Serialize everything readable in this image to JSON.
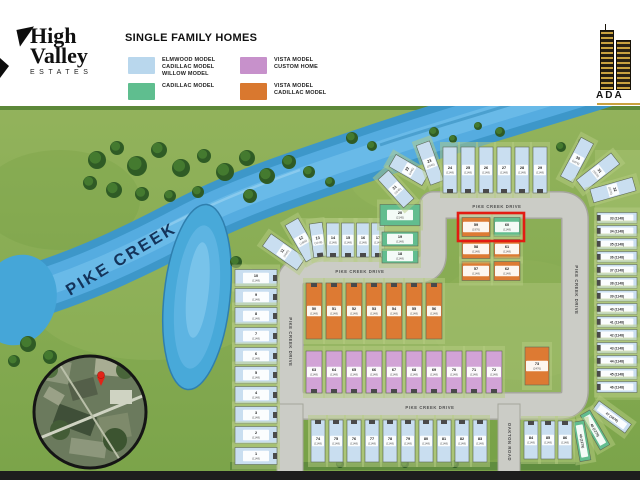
{
  "brand": {
    "line1": "High",
    "line2": "Valley",
    "line3": "ESTATES"
  },
  "legend": {
    "title": "SINGLE FAMILY HOMES",
    "items": [
      {
        "color": "#b9d7ed",
        "lines": [
          "ELMWOOD MODEL",
          "CADILLAC MODEL",
          "WILLOW MODEL"
        ]
      },
      {
        "color": "#5fbe8f",
        "lines": [
          "CADILLAC MODEL"
        ]
      },
      {
        "color": "#c791cb",
        "lines": [
          "VISTA MODEL",
          "CUSTOM HOME"
        ]
      },
      {
        "color": "#d9782f",
        "lines": [
          "VISTA MODEL",
          "CADILLAC MODEL"
        ]
      }
    ]
  },
  "builder": {
    "name": "ADA"
  },
  "site": {
    "creek_label": "PIKE CREEK",
    "colors": {
      "blue": "#c9def0",
      "green": "#62bd8f",
      "pink": "#d2a3d6",
      "orange": "#dd7a33"
    },
    "highlight": {
      "x": 458,
      "y": 213,
      "w": 66,
      "h": 28,
      "color": "#e31b12"
    },
    "roads": [
      {
        "label": "PIKE CREEK DRIVE",
        "x": 497,
        "y": 207,
        "r": 0
      },
      {
        "label": "PIKE CREEK DRIVE",
        "x": 360,
        "y": 272,
        "r": 0
      },
      {
        "label": "PIKE CREEK DRIVE",
        "x": 290,
        "y": 342,
        "r": 90
      },
      {
        "label": "PIKE CREEK DRIVE",
        "x": 576,
        "y": 290,
        "r": 90
      },
      {
        "label": "PIKE CREEK DRIVE",
        "x": 430,
        "y": 408,
        "r": 0
      },
      {
        "label": "OAKTON ROAD",
        "x": 509,
        "y": 442,
        "r": 90
      }
    ],
    "trees": [
      [
        97,
        160,
        9
      ],
      [
        117,
        148,
        7
      ],
      [
        137,
        166,
        10
      ],
      [
        159,
        150,
        8
      ],
      [
        181,
        168,
        9
      ],
      [
        204,
        156,
        7
      ],
      [
        225,
        172,
        9
      ],
      [
        247,
        158,
        8
      ],
      [
        267,
        176,
        8
      ],
      [
        289,
        162,
        7
      ],
      [
        90,
        183,
        7
      ],
      [
        114,
        190,
        8
      ],
      [
        142,
        194,
        7
      ],
      [
        170,
        196,
        6
      ],
      [
        198,
        192,
        6
      ],
      [
        309,
        172,
        6
      ],
      [
        330,
        182,
        5
      ],
      [
        250,
        196,
        7
      ],
      [
        28,
        344,
        8
      ],
      [
        50,
        357,
        7
      ],
      [
        14,
        361,
        6
      ],
      [
        236,
        262,
        6
      ],
      [
        352,
        138,
        6
      ],
      [
        372,
        146,
        5
      ],
      [
        434,
        132,
        5
      ],
      [
        453,
        139,
        4
      ],
      [
        500,
        132,
        5
      ],
      [
        478,
        126,
        4
      ],
      [
        561,
        147,
        5
      ],
      [
        582,
        142,
        4
      ],
      [
        340,
        464,
        4
      ],
      [
        405,
        464,
        4
      ],
      [
        455,
        464,
        4
      ]
    ],
    "lots": [
      {
        "n": "10",
        "s": "(1148)",
        "x": 256,
        "y": 278,
        "w": 42,
        "h": 17,
        "r": 0,
        "c": "blue",
        "d": "r"
      },
      {
        "n": "9",
        "s": "(1148)",
        "x": 256,
        "y": 297,
        "w": 42,
        "h": 17,
        "r": 0,
        "c": "blue",
        "d": "r"
      },
      {
        "n": "8",
        "s": "(1148)",
        "x": 256,
        "y": 316,
        "w": 42,
        "h": 17,
        "r": 0,
        "c": "blue",
        "d": "r"
      },
      {
        "n": "7",
        "s": "(1148)",
        "x": 256,
        "y": 336,
        "w": 42,
        "h": 17,
        "r": 0,
        "c": "blue",
        "d": "r"
      },
      {
        "n": "6",
        "s": "(1148)",
        "x": 256,
        "y": 356,
        "w": 42,
        "h": 17,
        "r": 0,
        "c": "blue",
        "d": "r"
      },
      {
        "n": "5",
        "s": "(1148)",
        "x": 256,
        "y": 375,
        "w": 42,
        "h": 17,
        "r": 0,
        "c": "blue",
        "d": "r"
      },
      {
        "n": "4",
        "s": "(1148)",
        "x": 256,
        "y": 395,
        "w": 42,
        "h": 17,
        "r": 0,
        "c": "blue",
        "d": "r"
      },
      {
        "n": "3",
        "s": "(1148)",
        "x": 256,
        "y": 415,
        "w": 42,
        "h": 17,
        "r": 0,
        "c": "blue",
        "d": "r"
      },
      {
        "n": "2",
        "s": "(1148)",
        "x": 256,
        "y": 435,
        "w": 42,
        "h": 17,
        "r": 0,
        "c": "blue",
        "d": "r"
      },
      {
        "n": "1",
        "s": "(1148)",
        "x": 256,
        "y": 456,
        "w": 42,
        "h": 17,
        "r": 0,
        "c": "blue",
        "d": "r"
      },
      {
        "n": "11",
        "s": "(1645)",
        "x": 284,
        "y": 252,
        "w": 15,
        "h": 42,
        "r": -55,
        "c": "blue"
      },
      {
        "n": "12",
        "s": "(1645)",
        "x": 302,
        "y": 240,
        "w": 15,
        "h": 42,
        "r": -30,
        "c": "blue"
      },
      {
        "n": "13",
        "s": "(1148)",
        "x": 318,
        "y": 240,
        "w": 13,
        "h": 34,
        "r": -8,
        "c": "blue",
        "d": "b"
      },
      {
        "n": "14",
        "s": "(1148)",
        "x": 333,
        "y": 240,
        "w": 13,
        "h": 34,
        "r": 0,
        "c": "blue",
        "d": "b"
      },
      {
        "n": "15",
        "s": "(1148)",
        "x": 348,
        "y": 240,
        "w": 13,
        "h": 34,
        "r": 0,
        "c": "blue",
        "d": "b"
      },
      {
        "n": "16",
        "s": "(1148)",
        "x": 363,
        "y": 240,
        "w": 13,
        "h": 34,
        "r": 0,
        "c": "blue",
        "d": "b"
      },
      {
        "n": "17",
        "s": "(1148)",
        "x": 378,
        "y": 240,
        "w": 13,
        "h": 34,
        "r": 0,
        "c": "blue",
        "d": "b"
      },
      {
        "n": "18",
        "s": "(1148)",
        "x": 400,
        "y": 256,
        "w": 36,
        "h": 14,
        "r": 0,
        "c": "green"
      },
      {
        "n": "19",
        "s": "(1148)",
        "x": 400,
        "y": 239,
        "w": 36,
        "h": 14,
        "r": 0,
        "c": "green"
      },
      {
        "n": "20",
        "s": "(2145)",
        "x": 400,
        "y": 215,
        "w": 40,
        "h": 21,
        "r": 0,
        "c": "green"
      },
      {
        "n": "21",
        "s": "(1645)",
        "x": 396,
        "y": 189,
        "w": 14,
        "h": 38,
        "r": -42,
        "c": "blue"
      },
      {
        "n": "22",
        "s": "(1645)",
        "x": 409,
        "y": 170,
        "w": 14,
        "h": 38,
        "r": -60,
        "c": "blue"
      },
      {
        "n": "23",
        "s": "(1645)",
        "x": 430,
        "y": 163,
        "w": 14,
        "h": 42,
        "r": -20,
        "c": "blue"
      },
      {
        "n": "24",
        "s": "(1148)",
        "x": 450,
        "y": 170,
        "w": 14,
        "h": 46,
        "r": 0,
        "c": "blue",
        "d": "b"
      },
      {
        "n": "25",
        "s": "(1148)",
        "x": 468,
        "y": 170,
        "w": 14,
        "h": 46,
        "r": 0,
        "c": "blue",
        "d": "b"
      },
      {
        "n": "26",
        "s": "(1148)",
        "x": 486,
        "y": 170,
        "w": 14,
        "h": 46,
        "r": 0,
        "c": "blue",
        "d": "b"
      },
      {
        "n": "27",
        "s": "(1148)",
        "x": 504,
        "y": 170,
        "w": 14,
        "h": 46,
        "r": 0,
        "c": "blue",
        "d": "b"
      },
      {
        "n": "28",
        "s": "(1148)",
        "x": 522,
        "y": 170,
        "w": 14,
        "h": 46,
        "r": 0,
        "c": "blue",
        "d": "b"
      },
      {
        "n": "29",
        "s": "(1148)",
        "x": 540,
        "y": 170,
        "w": 14,
        "h": 46,
        "r": 0,
        "c": "blue",
        "d": "b"
      },
      {
        "n": "30",
        "s": "(1676)",
        "x": 577,
        "y": 160,
        "w": 14,
        "h": 44,
        "r": 28,
        "c": "blue"
      },
      {
        "n": "31",
        "s": "(1676)",
        "x": 598,
        "y": 172,
        "w": 14,
        "h": 44,
        "r": 52,
        "c": "blue"
      },
      {
        "n": "32",
        "s": "(1676)",
        "x": 613,
        "y": 190,
        "w": 14,
        "h": 44,
        "r": 74,
        "c": "blue"
      },
      {
        "n": "33",
        "s": "(1148)",
        "x": 617,
        "y": 218,
        "w": 40,
        "h": 11,
        "r": 0,
        "c": "blue",
        "d": "l"
      },
      {
        "n": "34",
        "s": "(1148)",
        "x": 617,
        "y": 231,
        "w": 40,
        "h": 11,
        "r": 0,
        "c": "blue",
        "d": "l"
      },
      {
        "n": "35",
        "s": "(1148)",
        "x": 617,
        "y": 244,
        "w": 40,
        "h": 11,
        "r": 0,
        "c": "blue",
        "d": "l"
      },
      {
        "n": "36",
        "s": "(1148)",
        "x": 617,
        "y": 257,
        "w": 40,
        "h": 11,
        "r": 0,
        "c": "blue",
        "d": "l"
      },
      {
        "n": "37",
        "s": "(1148)",
        "x": 617,
        "y": 270,
        "w": 40,
        "h": 11,
        "r": 0,
        "c": "blue",
        "d": "l"
      },
      {
        "n": "38",
        "s": "(1148)",
        "x": 617,
        "y": 283,
        "w": 40,
        "h": 11,
        "r": 0,
        "c": "blue",
        "d": "l"
      },
      {
        "n": "39",
        "s": "(1148)",
        "x": 617,
        "y": 296,
        "w": 40,
        "h": 11,
        "r": 0,
        "c": "blue",
        "d": "l"
      },
      {
        "n": "40",
        "s": "(1148)",
        "x": 617,
        "y": 309,
        "w": 40,
        "h": 11,
        "r": 0,
        "c": "blue",
        "d": "l"
      },
      {
        "n": "41",
        "s": "(1148)",
        "x": 617,
        "y": 322,
        "w": 40,
        "h": 11,
        "r": 0,
        "c": "blue",
        "d": "l"
      },
      {
        "n": "42",
        "s": "(1148)",
        "x": 617,
        "y": 335,
        "w": 40,
        "h": 11,
        "r": 0,
        "c": "blue",
        "d": "l"
      },
      {
        "n": "43",
        "s": "(1148)",
        "x": 617,
        "y": 348,
        "w": 40,
        "h": 11,
        "r": 0,
        "c": "blue",
        "d": "l"
      },
      {
        "n": "44",
        "s": "(1148)",
        "x": 617,
        "y": 361,
        "w": 40,
        "h": 11,
        "r": 0,
        "c": "blue",
        "d": "l"
      },
      {
        "n": "45",
        "s": "(1148)",
        "x": 617,
        "y": 374,
        "w": 40,
        "h": 11,
        "r": 0,
        "c": "blue",
        "d": "l"
      },
      {
        "n": "46",
        "s": "(1148)",
        "x": 617,
        "y": 387,
        "w": 40,
        "h": 11,
        "r": 0,
        "c": "blue",
        "d": "l"
      },
      {
        "n": "47",
        "s": "(1676)",
        "x": 612,
        "y": 417,
        "w": 40,
        "h": 11,
        "r": 36,
        "c": "blue"
      },
      {
        "n": "48",
        "s": "(1279)",
        "x": 595,
        "y": 430,
        "w": 40,
        "h": 11,
        "r": 60,
        "c": "green"
      },
      {
        "n": "49",
        "s": "(1279)",
        "x": 582,
        "y": 441,
        "w": 40,
        "h": 11,
        "r": 80,
        "c": "green"
      },
      {
        "n": "50",
        "s": "(1148)",
        "x": 314,
        "y": 311,
        "w": 16,
        "h": 56,
        "r": 0,
        "c": "orange",
        "d": "t"
      },
      {
        "n": "51",
        "s": "(1148)",
        "x": 334,
        "y": 311,
        "w": 16,
        "h": 56,
        "r": 0,
        "c": "orange",
        "d": "t"
      },
      {
        "n": "52",
        "s": "(1148)",
        "x": 354,
        "y": 311,
        "w": 16,
        "h": 56,
        "r": 0,
        "c": "orange",
        "d": "t"
      },
      {
        "n": "53",
        "s": "(1148)",
        "x": 374,
        "y": 311,
        "w": 16,
        "h": 56,
        "r": 0,
        "c": "orange",
        "d": "t"
      },
      {
        "n": "54",
        "s": "(1148)",
        "x": 394,
        "y": 311,
        "w": 16,
        "h": 56,
        "r": 0,
        "c": "orange",
        "d": "t"
      },
      {
        "n": "55",
        "s": "(1148)",
        "x": 414,
        "y": 311,
        "w": 16,
        "h": 56,
        "r": 0,
        "c": "orange",
        "d": "t"
      },
      {
        "n": "56",
        "s": "(1148)",
        "x": 434,
        "y": 311,
        "w": 16,
        "h": 56,
        "r": 0,
        "c": "orange",
        "d": "t"
      },
      {
        "n": "57",
        "s": "(1148)",
        "x": 476,
        "y": 271,
        "w": 28,
        "h": 19,
        "r": 0,
        "c": "orange"
      },
      {
        "n": "58",
        "s": "(1148)",
        "x": 476,
        "y": 249,
        "w": 28,
        "h": 19,
        "r": 0,
        "c": "orange"
      },
      {
        "n": "59",
        "s": "(1976)",
        "x": 476,
        "y": 227,
        "w": 28,
        "h": 19,
        "r": 0,
        "c": "orange"
      },
      {
        "n": "60",
        "s": "(1148)",
        "x": 507,
        "y": 227,
        "w": 26,
        "h": 19,
        "r": 0,
        "c": "green"
      },
      {
        "n": "61",
        "s": "(1148)",
        "x": 507,
        "y": 249,
        "w": 26,
        "h": 19,
        "r": 0,
        "c": "orange"
      },
      {
        "n": "62",
        "s": "(1148)",
        "x": 507,
        "y": 271,
        "w": 26,
        "h": 19,
        "r": 0,
        "c": "orange"
      },
      {
        "n": "63",
        "s": "(1148)",
        "x": 314,
        "y": 372,
        "w": 16,
        "h": 42,
        "r": 0,
        "c": "pink",
        "d": "b"
      },
      {
        "n": "64",
        "s": "(1148)",
        "x": 334,
        "y": 372,
        "w": 16,
        "h": 42,
        "r": 0,
        "c": "pink",
        "d": "b"
      },
      {
        "n": "65",
        "s": "(1148)",
        "x": 354,
        "y": 372,
        "w": 16,
        "h": 42,
        "r": 0,
        "c": "pink",
        "d": "b"
      },
      {
        "n": "66",
        "s": "(1148)",
        "x": 374,
        "y": 372,
        "w": 16,
        "h": 42,
        "r": 0,
        "c": "pink",
        "d": "b"
      },
      {
        "n": "67",
        "s": "(1148)",
        "x": 394,
        "y": 372,
        "w": 16,
        "h": 42,
        "r": 0,
        "c": "pink",
        "d": "b"
      },
      {
        "n": "68",
        "s": "(1148)",
        "x": 414,
        "y": 372,
        "w": 16,
        "h": 42,
        "r": 0,
        "c": "pink",
        "d": "b"
      },
      {
        "n": "69",
        "s": "(1148)",
        "x": 434,
        "y": 372,
        "w": 16,
        "h": 42,
        "r": 0,
        "c": "pink",
        "d": "b"
      },
      {
        "n": "70",
        "s": "(1148)",
        "x": 454,
        "y": 372,
        "w": 16,
        "h": 42,
        "r": 0,
        "c": "pink",
        "d": "b"
      },
      {
        "n": "71",
        "s": "(1148)",
        "x": 474,
        "y": 372,
        "w": 16,
        "h": 42,
        "r": 0,
        "c": "pink",
        "d": "b"
      },
      {
        "n": "72",
        "s": "(1148)",
        "x": 494,
        "y": 372,
        "w": 16,
        "h": 42,
        "r": 0,
        "c": "pink",
        "d": "b"
      },
      {
        "n": "73",
        "s": "(2476)",
        "x": 537,
        "y": 366,
        "w": 24,
        "h": 38,
        "r": 0,
        "c": "orange"
      },
      {
        "n": "74",
        "s": "(1148)",
        "x": 318,
        "y": 441,
        "w": 14,
        "h": 42,
        "r": 0,
        "c": "blue",
        "d": "t"
      },
      {
        "n": "75",
        "s": "(1148)",
        "x": 336,
        "y": 441,
        "w": 14,
        "h": 42,
        "r": 0,
        "c": "blue",
        "d": "t"
      },
      {
        "n": "76",
        "s": "(1148)",
        "x": 354,
        "y": 441,
        "w": 14,
        "h": 42,
        "r": 0,
        "c": "blue",
        "d": "t"
      },
      {
        "n": "77",
        "s": "(1148)",
        "x": 372,
        "y": 441,
        "w": 14,
        "h": 42,
        "r": 0,
        "c": "blue",
        "d": "t"
      },
      {
        "n": "78",
        "s": "(1148)",
        "x": 390,
        "y": 441,
        "w": 14,
        "h": 42,
        "r": 0,
        "c": "blue",
        "d": "t"
      },
      {
        "n": "79",
        "s": "(1148)",
        "x": 408,
        "y": 441,
        "w": 14,
        "h": 42,
        "r": 0,
        "c": "blue",
        "d": "t"
      },
      {
        "n": "80",
        "s": "(1148)",
        "x": 426,
        "y": 441,
        "w": 14,
        "h": 42,
        "r": 0,
        "c": "blue",
        "d": "t"
      },
      {
        "n": "81",
        "s": "(1148)",
        "x": 444,
        "y": 441,
        "w": 14,
        "h": 42,
        "r": 0,
        "c": "blue",
        "d": "t"
      },
      {
        "n": "82",
        "s": "(1148)",
        "x": 462,
        "y": 441,
        "w": 14,
        "h": 42,
        "r": 0,
        "c": "blue",
        "d": "t"
      },
      {
        "n": "83",
        "s": "(1148)",
        "x": 480,
        "y": 441,
        "w": 14,
        "h": 42,
        "r": 0,
        "c": "blue",
        "d": "t"
      },
      {
        "n": "84",
        "s": "(1148)",
        "x": 531,
        "y": 440,
        "w": 14,
        "h": 38,
        "r": 0,
        "c": "blue",
        "d": "t"
      },
      {
        "n": "85",
        "s": "(1148)",
        "x": 548,
        "y": 440,
        "w": 14,
        "h": 38,
        "r": 0,
        "c": "blue",
        "d": "t"
      },
      {
        "n": "86",
        "s": "(1148)",
        "x": 565,
        "y": 440,
        "w": 14,
        "h": 38,
        "r": 0,
        "c": "blue",
        "d": "t"
      }
    ]
  }
}
